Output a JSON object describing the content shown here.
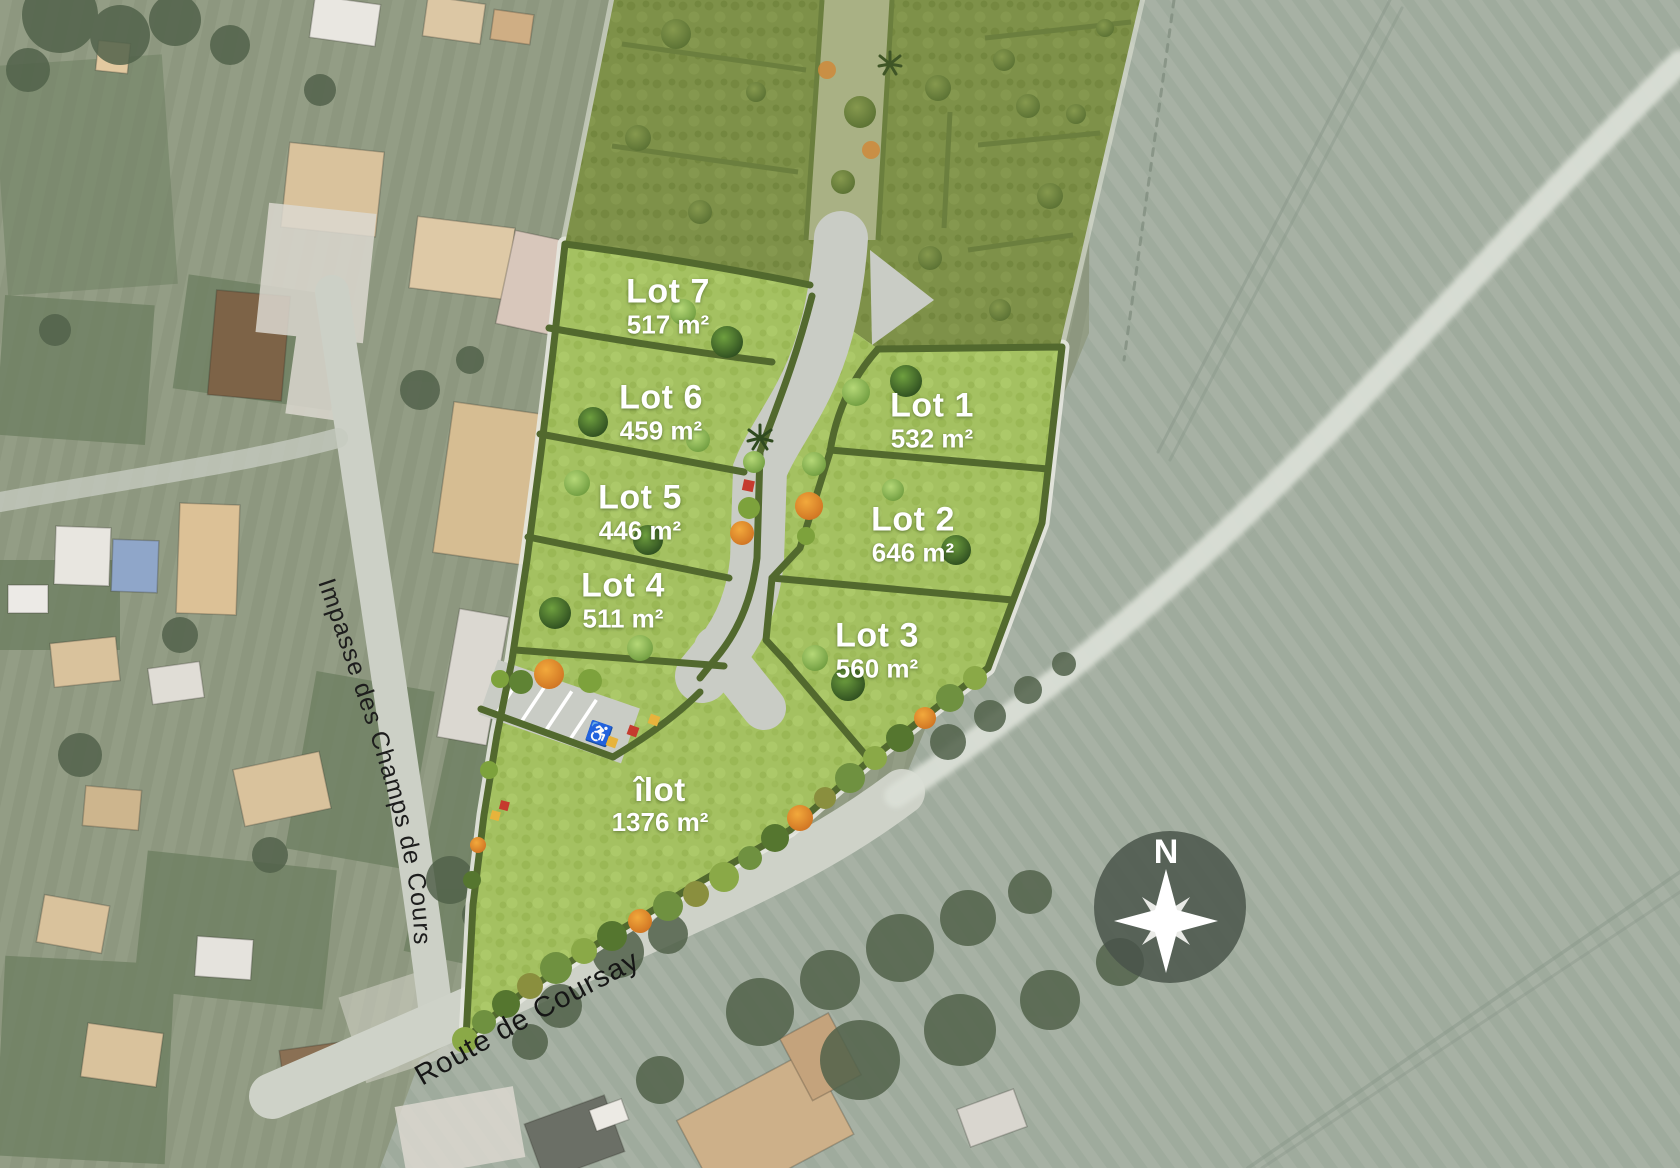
{
  "lots": [
    {
      "name": "Lot 1",
      "area": "532 m²"
    },
    {
      "name": "Lot 2",
      "area": "646 m²"
    },
    {
      "name": "Lot 3",
      "area": "560 m²"
    },
    {
      "name": "Lot 4",
      "area": "511 m²"
    },
    {
      "name": "Lot 5",
      "area": "446 m²"
    },
    {
      "name": "Lot 6",
      "area": "459 m²"
    },
    {
      "name": "Lot 7",
      "area": "517 m²"
    },
    {
      "name": "îlot",
      "area": "1376 m²"
    }
  ],
  "streets": {
    "impasse": "Impasse des Champs de Cours",
    "route": "Route de Coursay"
  },
  "compass": {
    "north_label": "N"
  },
  "parking": {
    "accessible_symbol": "♿"
  },
  "colors": {
    "lot_green": "#a4c161",
    "hedge_green": "#52692e",
    "existing_phase_green": "#7e9149",
    "road_gray": "#c9ccc5",
    "field_sage": "#9fab9d",
    "orange_shrub": "#e0862c",
    "compass_bg": "#49534a",
    "label_white": "#ffffff",
    "street_label_black": "#1d1d1d"
  }
}
